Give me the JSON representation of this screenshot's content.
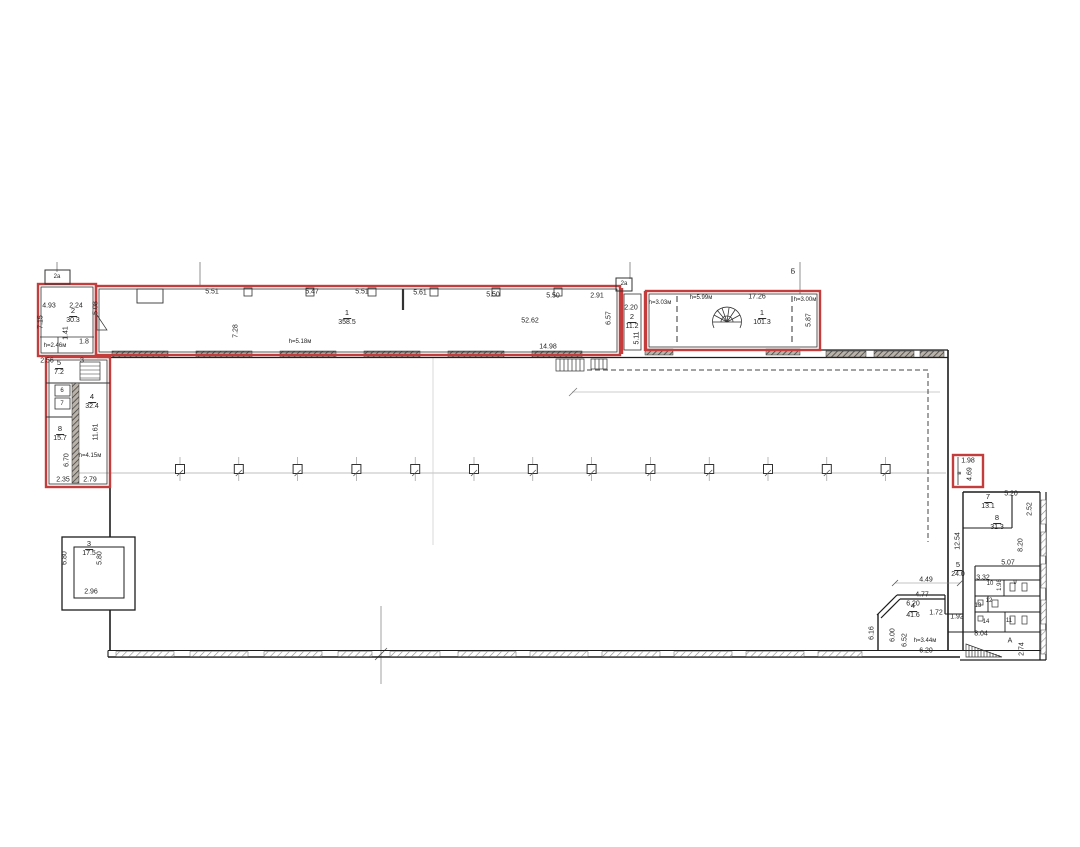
{
  "colors": {
    "red_outline": "#c43c3c",
    "wall": "#1c1c1c",
    "dim_text": "#1f1f1f",
    "background": "#ffffff"
  },
  "rooms": [
    {
      "num": "2",
      "area": "30.3",
      "x": 73,
      "y": 316
    },
    {
      "num": "1",
      "area": "358.5",
      "x": 347,
      "y": 318
    },
    {
      "num": "2",
      "area": "11.2",
      "x": 632,
      "y": 322
    },
    {
      "num": "1",
      "area": "101.3",
      "x": 762,
      "y": 318
    },
    {
      "num": "5",
      "area": "7.2",
      "x": 59,
      "y": 368
    },
    {
      "num": "4",
      "area": "32.4",
      "x": 92,
      "y": 402
    },
    {
      "num": "8",
      "area": "15.7",
      "x": 60,
      "y": 434
    },
    {
      "num": "3",
      "area": "17.5",
      "x": 89,
      "y": 549
    },
    {
      "num": "7",
      "area": "13.1",
      "x": 988,
      "y": 502
    },
    {
      "num": "8",
      "area": "31.3",
      "x": 997,
      "y": 523
    },
    {
      "num": "5",
      "area": "24.0",
      "x": 958,
      "y": 570
    },
    {
      "num": "4",
      "area": "41.6",
      "x": 913,
      "y": 611
    }
  ],
  "annotations": [
    {
      "t": "2а",
      "x": 57,
      "y": 277,
      "fs": 6,
      "n": "grid-label"
    },
    {
      "t": "4.93",
      "x": 49,
      "y": 306
    },
    {
      "t": "2.24",
      "x": 76,
      "y": 306
    },
    {
      "t": "7.15",
      "x": 41,
      "y": 322,
      "r": -90
    },
    {
      "t": "5.08",
      "x": 96,
      "y": 308,
      "r": -90
    },
    {
      "t": "1.41",
      "x": 66,
      "y": 333,
      "r": -90
    },
    {
      "t": "1.8",
      "x": 84,
      "y": 342
    },
    {
      "t": "h=2.46м",
      "x": 55,
      "y": 346,
      "fs": 6
    },
    {
      "t": "5.51",
      "x": 212,
      "y": 292
    },
    {
      "t": "5.47",
      "x": 312,
      "y": 292
    },
    {
      "t": "5.51",
      "x": 362,
      "y": 292
    },
    {
      "t": "5.61",
      "x": 420,
      "y": 293
    },
    {
      "t": "5.50",
      "x": 493,
      "y": 295
    },
    {
      "t": "5.50",
      "x": 553,
      "y": 296
    },
    {
      "t": "2.91",
      "x": 597,
      "y": 296
    },
    {
      "t": "7.28",
      "x": 236,
      "y": 331,
      "r": -90
    },
    {
      "t": "h=5.18м",
      "x": 300,
      "y": 342,
      "fs": 6
    },
    {
      "t": "52.62",
      "x": 530,
      "y": 321
    },
    {
      "t": "14.98",
      "x": 548,
      "y": 347
    },
    {
      "t": "6.57",
      "x": 609,
      "y": 318,
      "r": -90
    },
    {
      "t": "2а",
      "x": 624,
      "y": 284,
      "fs": 6,
      "n": "grid-label"
    },
    {
      "t": "2.20",
      "x": 631,
      "y": 308
    },
    {
      "t": "5.11",
      "x": 637,
      "y": 338,
      "r": -90
    },
    {
      "t": "h=3.03м",
      "x": 660,
      "y": 303,
      "fs": 6
    },
    {
      "t": "h=5.99м",
      "x": 701,
      "y": 298,
      "fs": 6
    },
    {
      "t": "17.26",
      "x": 757,
      "y": 297
    },
    {
      "t": "h=3.00м",
      "x": 805,
      "y": 300,
      "fs": 6
    },
    {
      "t": "5.87",
      "x": 809,
      "y": 320,
      "r": -90
    },
    {
      "t": "Б",
      "x": 793,
      "y": 272,
      "n": "grid-label"
    },
    {
      "t": "2.56",
      "x": 47,
      "y": 361
    },
    {
      "t": "3",
      "x": 82,
      "y": 361,
      "n": "room-number"
    },
    {
      "t": "6",
      "x": 62,
      "y": 391,
      "fs": 6,
      "n": "room-number"
    },
    {
      "t": "7",
      "x": 62,
      "y": 404,
      "fs": 6,
      "n": "room-number"
    },
    {
      "t": "11.61",
      "x": 96,
      "y": 432,
      "r": -90
    },
    {
      "t": "h=4.15м",
      "x": 90,
      "y": 456,
      "fs": 6
    },
    {
      "t": "6.70",
      "x": 67,
      "y": 460,
      "r": -90
    },
    {
      "t": "2.35",
      "x": 63,
      "y": 480
    },
    {
      "t": "2.79",
      "x": 90,
      "y": 480
    },
    {
      "t": "6.80",
      "x": 65,
      "y": 558,
      "r": -90
    },
    {
      "t": "5.80",
      "x": 100,
      "y": 558,
      "r": -90
    },
    {
      "t": "2.96",
      "x": 91,
      "y": 592
    },
    {
      "t": "1.98",
      "x": 968,
      "y": 461
    },
    {
      "t": "в",
      "x": 960,
      "y": 473,
      "r": -90,
      "fs": 6,
      "n": "room-number"
    },
    {
      "t": "4.69",
      "x": 970,
      "y": 474,
      "r": -90
    },
    {
      "t": "5.20",
      "x": 1011,
      "y": 494
    },
    {
      "t": "2.52",
      "x": 1030,
      "y": 509,
      "r": -90
    },
    {
      "t": "12.54",
      "x": 958,
      "y": 541,
      "r": -90
    },
    {
      "t": "8.20",
      "x": 1021,
      "y": 545,
      "r": -90
    },
    {
      "t": "5.07",
      "x": 1008,
      "y": 563
    },
    {
      "t": "3.32",
      "x": 983,
      "y": 578
    },
    {
      "t": "10",
      "x": 990,
      "y": 584,
      "fs": 6,
      "n": "room-number"
    },
    {
      "t": "1.98",
      "x": 1000,
      "y": 585,
      "r": -90,
      "fs": 6
    },
    {
      "t": "9",
      "x": 1015,
      "y": 583,
      "fs": 6,
      "n": "room-number"
    },
    {
      "t": "12",
      "x": 989,
      "y": 601,
      "fs": 6,
      "n": "room-number"
    },
    {
      "t": "13",
      "x": 978,
      "y": 606,
      "fs": 6,
      "n": "room-number"
    },
    {
      "t": "14",
      "x": 986,
      "y": 622,
      "fs": 6,
      "n": "room-number"
    },
    {
      "t": "11",
      "x": 1009,
      "y": 621,
      "fs": 6,
      "n": "room-number"
    },
    {
      "t": "1.92",
      "x": 957,
      "y": 617
    },
    {
      "t": "8.04",
      "x": 981,
      "y": 634
    },
    {
      "t": "А",
      "x": 1010,
      "y": 641,
      "n": "room-number"
    },
    {
      "t": "2.74",
      "x": 1022,
      "y": 649,
      "r": -90
    },
    {
      "t": "4.49",
      "x": 926,
      "y": 580
    },
    {
      "t": "4.77",
      "x": 922,
      "y": 595
    },
    {
      "t": "6.20",
      "x": 913,
      "y": 604
    },
    {
      "t": "1.72",
      "x": 936,
      "y": 613
    },
    {
      "t": "6.16",
      "x": 872,
      "y": 633,
      "r": -90
    },
    {
      "t": "6.00",
      "x": 893,
      "y": 635,
      "r": -90
    },
    {
      "t": "6.52",
      "x": 905,
      "y": 640,
      "r": -90
    },
    {
      "t": "h=3.44м",
      "x": 925,
      "y": 641,
      "fs": 6
    },
    {
      "t": "6.20",
      "x": 926,
      "y": 651
    }
  ]
}
